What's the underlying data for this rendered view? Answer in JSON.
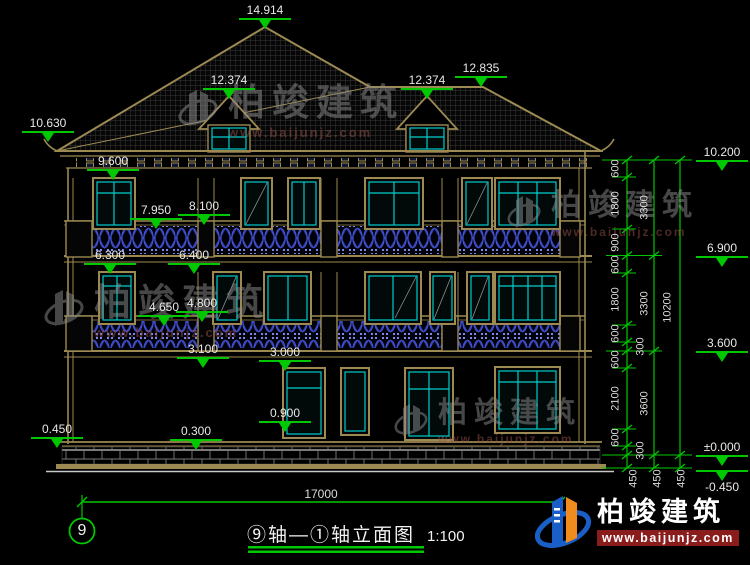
{
  "title": {
    "text": "⑨轴—①轴立面图",
    "scale": "1:100"
  },
  "axis": {
    "label": "9"
  },
  "dims": {
    "overall_width": "17000"
  },
  "markers": {
    "peak": "14.914",
    "dormer_left": "12.374",
    "dormer_right": "12.374",
    "ridge_right": "12.835",
    "eave_left": "10.630",
    "f3_window_top": "9.600",
    "f3_rail_left": "7.950",
    "f3_rail_right": "8.100",
    "f2_window_top_left": "6.300",
    "f2_window_top_right": "6.400",
    "f2_rail_left": "4.650",
    "f2_rail_right": "4.800",
    "f1_window_top_left": "3.100",
    "f1_window_top_right": "3.000",
    "f1_sill": "0.900",
    "plinth_left": "0.450",
    "plinth_mid": "0.300",
    "right_eave": "10.200",
    "right_f3": "6.900",
    "right_f2": "3.600",
    "right_ground": "±0.000",
    "right_outdoor": "-0.450"
  },
  "chains": {
    "detail": [
      "600",
      "1800",
      "900",
      "600",
      "1800",
      "600",
      "300",
      "600",
      "2100",
      "600",
      "300",
      "450"
    ],
    "story": [
      "3300",
      "3300",
      "3600",
      "450"
    ],
    "overall": [
      "10200",
      "450"
    ]
  },
  "watermark": {
    "brand": "柏竣建筑",
    "url": "www.baijunjz.com"
  },
  "logo": {
    "brand": "柏竣建筑",
    "url": "www.baijunjz.com"
  }
}
